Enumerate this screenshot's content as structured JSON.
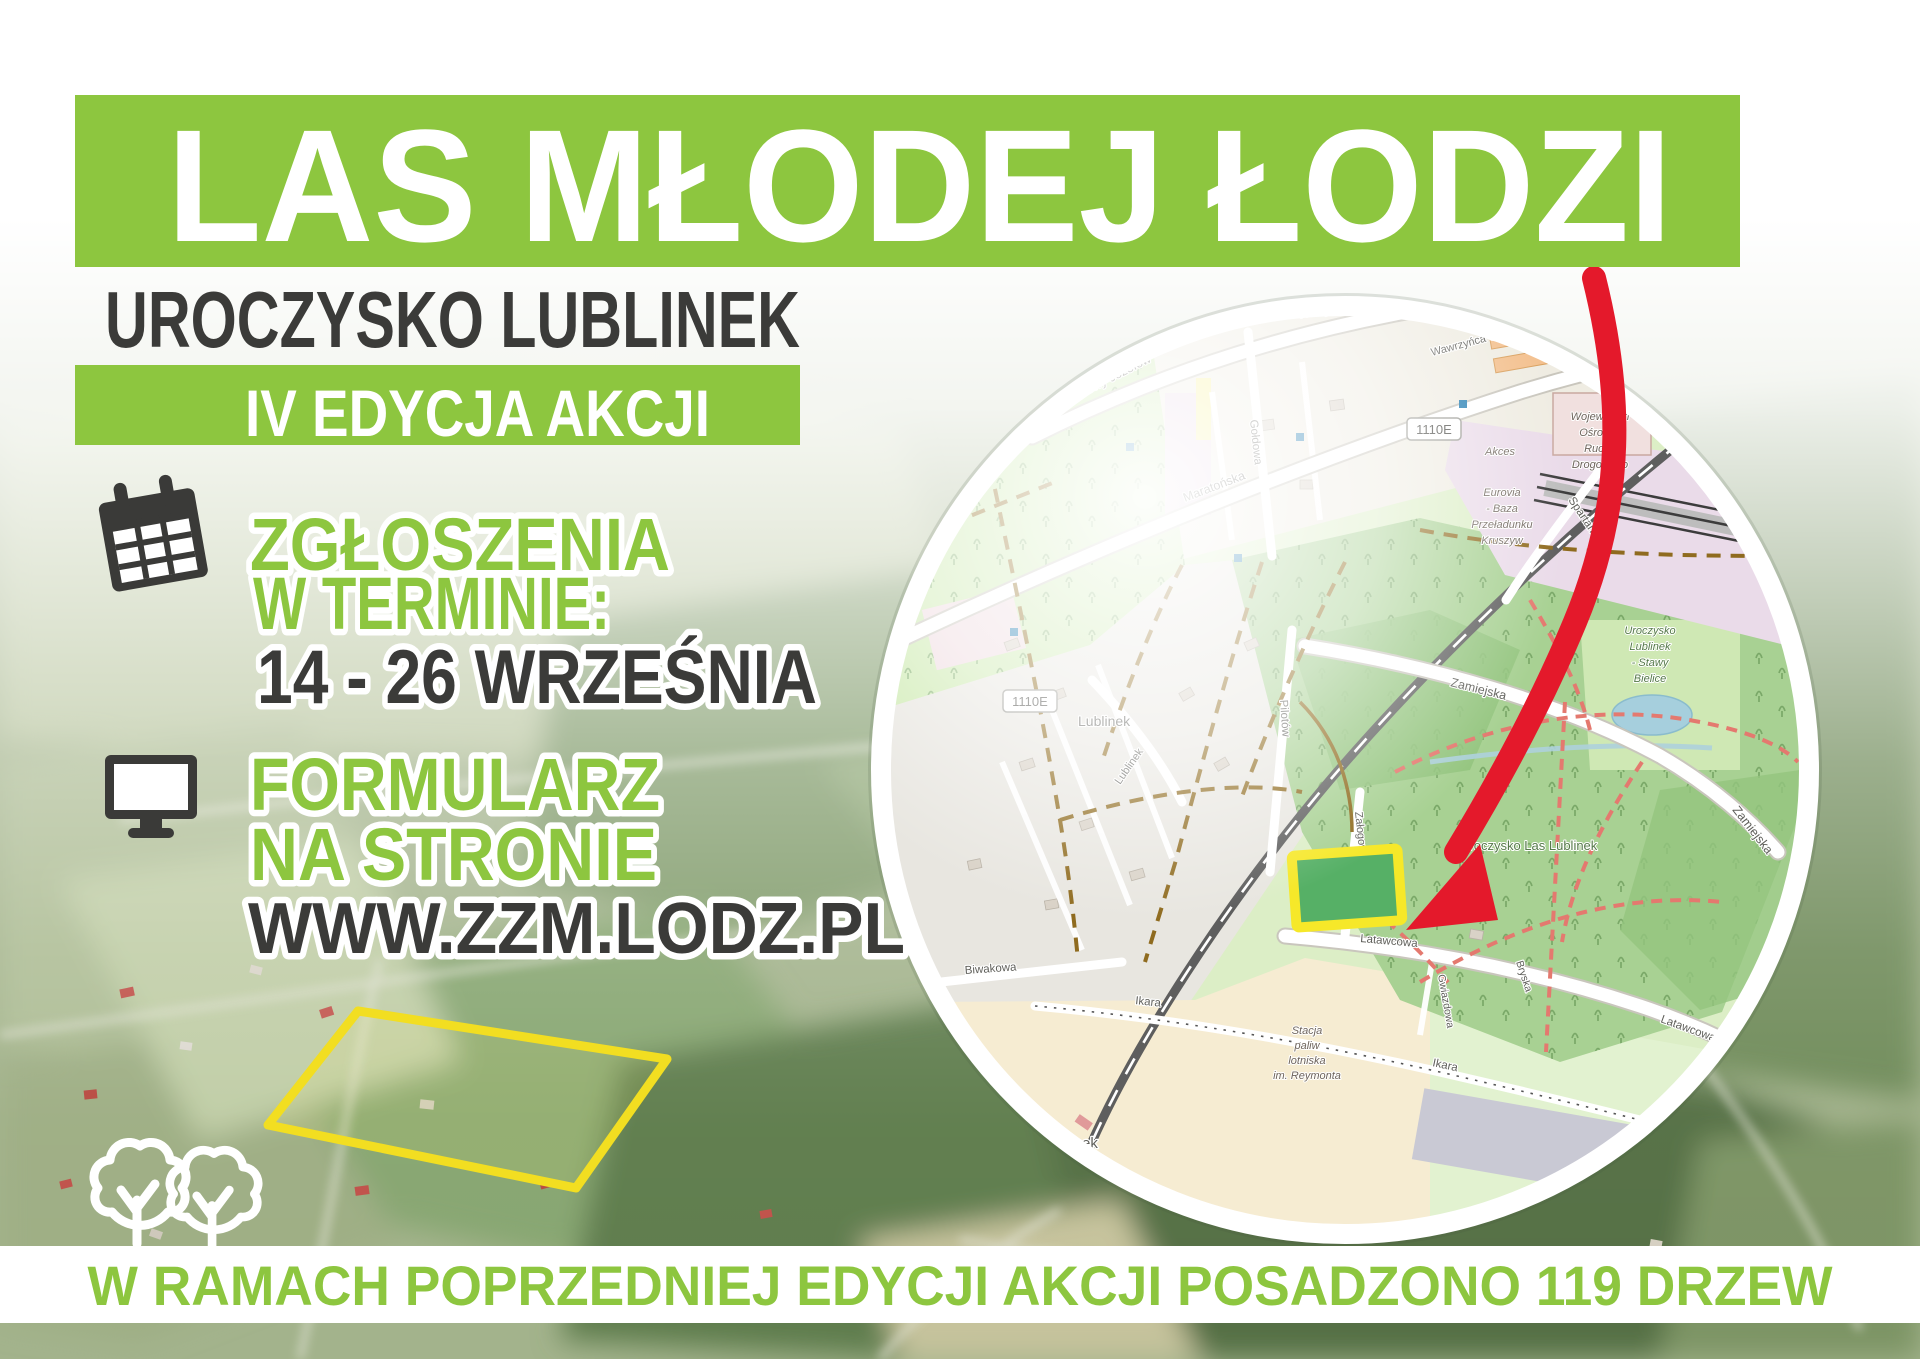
{
  "poster": {
    "title": "LAS MŁODEJ ŁODZI",
    "subtitle": "UROCZYSKO LUBLINEK",
    "edition_badge": "IV EDYCJA AKCJI",
    "signup": {
      "line1": "ZGŁOSZENIA",
      "line2": "W TERMINIE:",
      "dates": "14 - 26 WRZEŚNIA"
    },
    "form": {
      "line1": "FORMULARZ",
      "line2": "NA STRONIE",
      "url": "WWW.ZZM.LODZ.PL"
    },
    "footer": "W RAMACH POPRZEDNIEJ EDYCJI AKCJI POSADZONO 119 DRZEW",
    "icons": {
      "calendar": "calendar-icon",
      "monitor": "computer-icon",
      "trees": "trees-icon",
      "arrow": "red-arrow-icon",
      "site": "planting-site-marker"
    },
    "colors": {
      "green": "#8dc63f",
      "dark": "#3b3b39",
      "red": "#e4192b",
      "yellow": "#f6e829",
      "site_green": "#56b066"
    }
  },
  "map": {
    "streets": {
      "maratonska_a": "Maratońska",
      "maratonska_b": "Maratońska",
      "nowy_jozefow_a": "Nowy Józefów",
      "nowy_jozefow_b": "Nowy Józefów",
      "goldowa": "Gołdowa",
      "wawrzynca_cylla": "Wawrzyńca Cylla",
      "pilarska": "Pilarska",
      "zamiejska_a": "Zamiejska",
      "zamiejska_b": "Zamiejska",
      "spartanska": "Spartańska",
      "pilotow": "Pilotów",
      "zalogowa": "Załogowa",
      "latawcowa_a": "Latawcowa",
      "latawcowa_b": "Latawcowa",
      "biwakowa": "Biwakowa",
      "ikara_a": "Ikara",
      "ikara_b": "Ikara",
      "gwiazdowa": "Gwiazdowa",
      "bryska": "Bryska",
      "lublinek_street": "Lublinek",
      "uroczysko_road": "Uroczysko Lublinek"
    },
    "places": {
      "lublinek_village": "Lublinek",
      "lublinek_station": "Lublinek",
      "las_lublinek": "Uroczysko Las Lublinek"
    },
    "poi": {
      "word1": "Wojewódzki",
      "word2": "Ośrodek",
      "word3": "Ruchu",
      "word4": "Drogowego",
      "akces": "Akces",
      "eurovia1": "Eurovia",
      "eurovia2": "- Baza",
      "eurovia3": "Przeładunku",
      "eurovia4": "Kruszyw",
      "stawy1": "Uroczysko",
      "stawy2": "Lublinek",
      "stawy3": "- Stawy",
      "stawy4": "Bielice",
      "stacja1": "Stacja",
      "stacja2": "paliw",
      "stacja3": "lotniska",
      "stacja4": "im. Reymonta"
    },
    "badges": {
      "route_a": "1110E",
      "route_b": "1110E"
    }
  }
}
